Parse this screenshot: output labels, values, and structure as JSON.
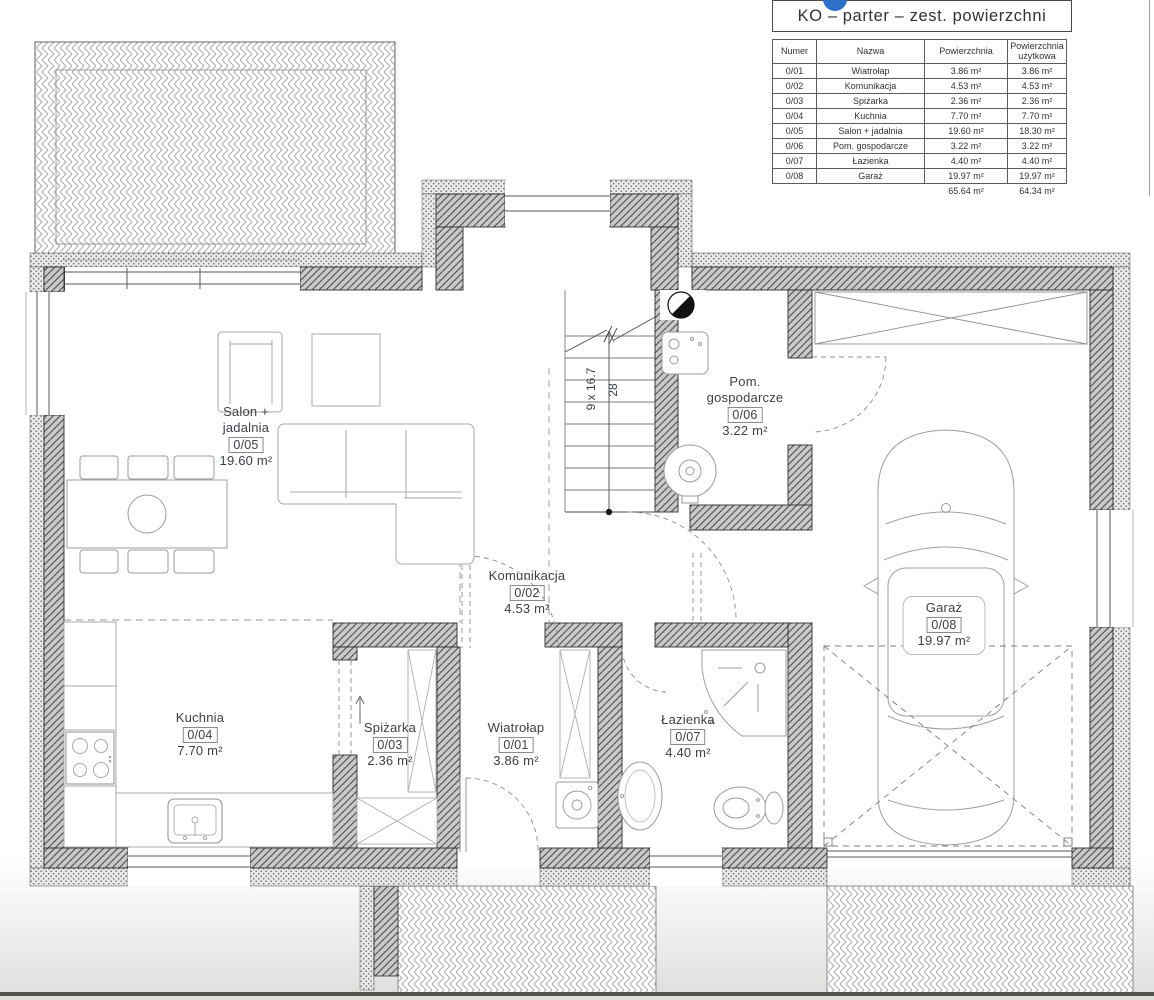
{
  "legend": {
    "title": "KO – parter – zest. powierzchni",
    "table": {
      "headers": [
        "Numer",
        "Nazwa",
        "Powierzchnia",
        "Powierzchnia użytkowa"
      ],
      "rows": [
        [
          "0/01",
          "Wiatrołap",
          "3.86 m²",
          "3.86 m²"
        ],
        [
          "0/02",
          "Komunikacja",
          "4.53 m²",
          "4.53 m²"
        ],
        [
          "0/03",
          "Spiżarka",
          "2.36 m²",
          "2.36 m²"
        ],
        [
          "0/04",
          "Kuchnia",
          "7.70 m²",
          "7.70 m²"
        ],
        [
          "0/05",
          "Salon + jadalnia",
          "19.60 m²",
          "18.30 m²"
        ],
        [
          "0/06",
          "Pom. gospodarcze",
          "3.22 m²",
          "3.22 m²"
        ],
        [
          "0/07",
          "Łazienka",
          "4.40 m²",
          "4.40 m²"
        ],
        [
          "0/08",
          "Garaż",
          "19.97 m²",
          "19.97 m²"
        ]
      ],
      "totals": [
        "65.64 m²",
        "64.34 m²"
      ]
    }
  },
  "rooms": [
    {
      "id": "0/01",
      "name": "Wiatrołap",
      "area": "3.86 m²"
    },
    {
      "id": "0/02",
      "name": "Komunikacja",
      "area": "4.53 m²"
    },
    {
      "id": "0/03",
      "name": "Spiżarka",
      "area": "2.36 m²"
    },
    {
      "id": "0/04",
      "name": "Kuchnia",
      "area": "7.70 m²"
    },
    {
      "id": "0/05",
      "name": "Salon +\njadalnia",
      "area": "19.60 m²"
    },
    {
      "id": "0/06",
      "name": "Pom.\ngospodarcze",
      "area": "3.22 m²"
    },
    {
      "id": "0/07",
      "name": "Łazienka",
      "area": "4.40 m²"
    },
    {
      "id": "0/08",
      "name": "Garaż",
      "area": "19.97 m²"
    }
  ],
  "stairs": {
    "steps_label": "9 x 16.7",
    "width_label": "28"
  },
  "colors": {
    "accent_blue": "#2e6fc9",
    "wall_line": "#2f2f2f",
    "text": "#3c4148"
  }
}
